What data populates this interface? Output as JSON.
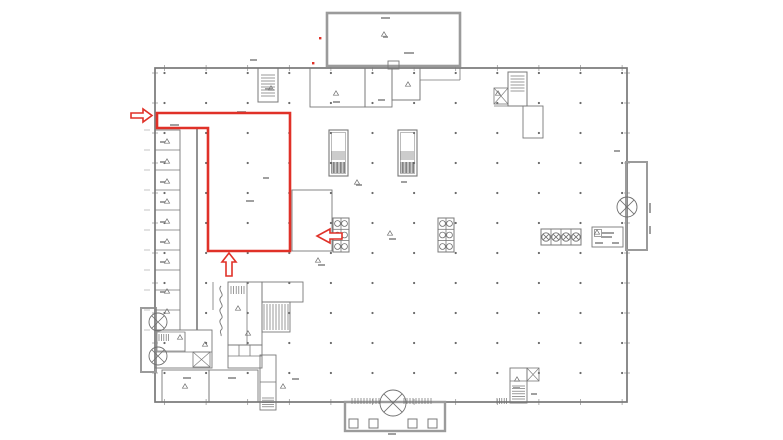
{
  "meta": {
    "description": "architectural floor plan with red highlighted zone and red arrows"
  },
  "colors": {
    "background": "#ffffff",
    "wall": "#787878",
    "wall_thick": "#9b9b9b",
    "hatch": "#6f6f6f",
    "hatch_dark": "#4f4f4f",
    "dot": "#6a6a6a",
    "tick": "#8d8d8d",
    "mark": "#a0a0a0",
    "symbol": "#6f6f6f",
    "red": "#e03128"
  },
  "plan": {
    "canvas": {
      "w": 783,
      "h": 440
    },
    "grid": {
      "x0": 164.5,
      "dx": 41.6,
      "cols": 12,
      "y0": 73,
      "dy": 30,
      "rows": 11,
      "r": 1.1
    },
    "left_dim_ticks": {
      "x1": 144,
      "x2": 150,
      "y0": 130,
      "dy": 20,
      "n": 11
    },
    "rects": [
      {
        "x": 155,
        "y": 68,
        "w": 472,
        "h": 334,
        "sw": 1.7,
        "k": "wall",
        "name": "building-outline"
      },
      {
        "x": 327,
        "y": 13,
        "w": 133,
        "h": 53,
        "sw": 2.6,
        "k": "wall_thick",
        "name": "top-annex"
      },
      {
        "x": 388,
        "y": 61,
        "w": 11,
        "h": 8,
        "sw": 0.9,
        "k": "wall",
        "name": "annex-door"
      },
      {
        "x": 345,
        "y": 402,
        "w": 100,
        "h": 29,
        "sw": 2.4,
        "k": "wall_thick",
        "name": "entrance-porch"
      },
      {
        "x": 349,
        "y": 419,
        "w": 9,
        "h": 9,
        "sw": 1,
        "k": "wall",
        "name": "porch-column"
      },
      {
        "x": 369,
        "y": 419,
        "w": 9,
        "h": 9,
        "sw": 1,
        "k": "wall",
        "name": "porch-column"
      },
      {
        "x": 408,
        "y": 419,
        "w": 9,
        "h": 9,
        "sw": 1,
        "k": "wall",
        "name": "porch-column"
      },
      {
        "x": 428,
        "y": 419,
        "w": 9,
        "h": 9,
        "sw": 1,
        "k": "wall",
        "name": "porch-column"
      },
      {
        "x": 141,
        "y": 308,
        "w": 15,
        "h": 64,
        "sw": 2,
        "k": "wall_thick",
        "name": "left-bay"
      },
      {
        "x": 626,
        "y": 162,
        "w": 21,
        "h": 88,
        "sw": 2,
        "k": "wall_thick",
        "name": "right-bay"
      },
      {
        "x": 155,
        "y": 130,
        "w": 25,
        "h": 200,
        "sw": 0.9,
        "k": "wall",
        "name": "left-room-column"
      },
      {
        "x": 155,
        "y": 330,
        "w": 57,
        "h": 38,
        "sw": 0.9,
        "k": "wall",
        "name": "left-room-block"
      },
      {
        "x": 157,
        "y": 332,
        "w": 28,
        "h": 19,
        "sw": 0.7,
        "k": "wall",
        "name": "left-inner-room"
      },
      {
        "x": 162,
        "y": 370,
        "w": 47,
        "h": 32,
        "sw": 0.9,
        "k": "wall",
        "name": "bottom-room-1"
      },
      {
        "x": 209,
        "y": 370,
        "w": 49,
        "h": 32,
        "sw": 0.9,
        "k": "wall",
        "name": "bottom-room-2"
      },
      {
        "x": 260,
        "y": 355,
        "w": 16,
        "h": 55,
        "sw": 0.9,
        "k": "wall",
        "name": "bottom-small-structure"
      },
      {
        "x": 228,
        "y": 282,
        "w": 34,
        "h": 63,
        "sw": 0.9,
        "k": "wall",
        "name": "core-room-a"
      },
      {
        "x": 262,
        "y": 282,
        "w": 41,
        "h": 20,
        "sw": 0.9,
        "k": "wall",
        "name": "core-room-b"
      },
      {
        "x": 262,
        "y": 302,
        "w": 28,
        "h": 30,
        "sw": 0.9,
        "k": "wall",
        "name": "core-stairs"
      },
      {
        "x": 228,
        "y": 345,
        "w": 34,
        "h": 23,
        "sw": 0.9,
        "k": "wall",
        "name": "core-cells"
      },
      {
        "x": 258,
        "y": 68,
        "w": 20,
        "h": 34,
        "sw": 1,
        "k": "wall",
        "name": "top-left-shaft"
      },
      {
        "x": 310,
        "y": 68,
        "w": 55,
        "h": 39,
        "sw": 0.9,
        "k": "wall",
        "name": "top-room-1"
      },
      {
        "x": 365,
        "y": 68,
        "w": 27,
        "h": 39,
        "sw": 0.9,
        "k": "wall",
        "name": "top-room-2"
      },
      {
        "x": 392,
        "y": 68,
        "w": 28,
        "h": 32,
        "sw": 0.9,
        "k": "wall",
        "name": "top-room-3"
      },
      {
        "x": 508,
        "y": 72,
        "w": 19,
        "h": 34,
        "sw": 1,
        "k": "wall",
        "name": "top-right-stair"
      },
      {
        "x": 523,
        "y": 106,
        "w": 20,
        "h": 32,
        "sw": 0.9,
        "k": "wall",
        "name": "top-right-room"
      },
      {
        "x": 292,
        "y": 190,
        "w": 40,
        "h": 61,
        "sw": 0.9,
        "k": "wall",
        "name": "mid-room"
      },
      {
        "x": 329,
        "y": 130,
        "w": 19,
        "h": 46,
        "sw": 1.1,
        "k": "wall",
        "name": "machine-1"
      },
      {
        "x": 331.5,
        "y": 132.5,
        "w": 14,
        "h": 41,
        "sw": 0.5,
        "k": "wall",
        "name": "machine-1-inner"
      },
      {
        "x": 398,
        "y": 130,
        "w": 19,
        "h": 46,
        "sw": 1.1,
        "k": "wall",
        "name": "machine-2"
      },
      {
        "x": 400.5,
        "y": 132.5,
        "w": 14,
        "h": 41,
        "sw": 0.5,
        "k": "wall",
        "name": "machine-2-inner"
      },
      {
        "x": 333,
        "y": 218,
        "w": 16,
        "h": 34,
        "sw": 1,
        "k": "wall",
        "name": "equipment-rack-1"
      },
      {
        "x": 438,
        "y": 218,
        "w": 16,
        "h": 34,
        "sw": 1,
        "k": "wall",
        "name": "equipment-rack-2"
      },
      {
        "x": 541,
        "y": 229,
        "w": 40,
        "h": 16,
        "sw": 1,
        "k": "wall",
        "name": "fan-unit-row"
      },
      {
        "x": 592,
        "y": 227,
        "w": 31,
        "h": 20,
        "sw": 0.9,
        "k": "wall",
        "name": "legend-box"
      },
      {
        "x": 594.5,
        "y": 229.5,
        "w": 7,
        "h": 7,
        "sw": 0.7,
        "k": "wall",
        "name": "legend-square"
      },
      {
        "x": 510,
        "y": 368,
        "w": 17,
        "h": 35,
        "sw": 0.9,
        "k": "wall",
        "name": "bottom-right-room"
      }
    ],
    "lines": [
      {
        "x1": 155,
        "y1": 150,
        "x2": 180,
        "y2": 150
      },
      {
        "x1": 155,
        "y1": 170,
        "x2": 180,
        "y2": 170
      },
      {
        "x1": 155,
        "y1": 190,
        "x2": 180,
        "y2": 190
      },
      {
        "x1": 155,
        "y1": 210,
        "x2": 180,
        "y2": 210
      },
      {
        "x1": 155,
        "y1": 230,
        "x2": 180,
        "y2": 230
      },
      {
        "x1": 155,
        "y1": 250,
        "x2": 180,
        "y2": 250
      },
      {
        "x1": 155,
        "y1": 270,
        "x2": 180,
        "y2": 270
      },
      {
        "x1": 155,
        "y1": 290,
        "x2": 180,
        "y2": 290
      },
      {
        "x1": 155,
        "y1": 310,
        "x2": 180,
        "y2": 310
      },
      {
        "x1": 197,
        "y1": 128,
        "x2": 197,
        "y2": 330,
        "sw": 1.6
      },
      {
        "x1": 155,
        "y1": 352,
        "x2": 212,
        "y2": 352,
        "sw": 0.7
      },
      {
        "x1": 185,
        "y1": 332,
        "x2": 185,
        "y2": 352,
        "sw": 0.7
      },
      {
        "x1": 260,
        "y1": 382,
        "x2": 276,
        "y2": 382
      },
      {
        "x1": 247,
        "y1": 282,
        "x2": 247,
        "y2": 345
      },
      {
        "x1": 213,
        "y1": 282,
        "x2": 213,
        "y2": 310
      },
      {
        "x1": 239,
        "y1": 345,
        "x2": 239,
        "y2": 356
      },
      {
        "x1": 250,
        "y1": 345,
        "x2": 250,
        "y2": 356
      },
      {
        "x1": 228,
        "y1": 356,
        "x2": 262,
        "y2": 356
      },
      {
        "x1": 420,
        "y1": 80,
        "x2": 460,
        "y2": 80
      },
      {
        "x1": 460,
        "y1": 68,
        "x2": 460,
        "y2": 80
      },
      {
        "x1": 420,
        "y1": 80,
        "x2": 420,
        "y2": 100
      },
      {
        "x1": 392,
        "y1": 100,
        "x2": 420,
        "y2": 100
      },
      {
        "x1": 494,
        "y1": 106,
        "x2": 527,
        "y2": 106
      },
      {
        "x1": 551,
        "y1": 229,
        "x2": 551,
        "y2": 245
      },
      {
        "x1": 561,
        "y1": 229,
        "x2": 561,
        "y2": 245
      },
      {
        "x1": 571,
        "y1": 229,
        "x2": 571,
        "y2": 245
      },
      {
        "x1": 333,
        "y1": 229.3,
        "x2": 349,
        "y2": 229.3
      },
      {
        "x1": 333,
        "y1": 240.6,
        "x2": 349,
        "y2": 240.6
      },
      {
        "x1": 341,
        "y1": 218,
        "x2": 341,
        "y2": 252
      },
      {
        "x1": 438,
        "y1": 229.3,
        "x2": 454,
        "y2": 229.3
      },
      {
        "x1": 438,
        "y1": 240.6,
        "x2": 454,
        "y2": 240.6
      },
      {
        "x1": 446,
        "y1": 218,
        "x2": 446,
        "y2": 252
      },
      {
        "x1": 510,
        "y1": 381,
        "x2": 527,
        "y2": 381
      }
    ],
    "combs": [
      {
        "x": 261,
        "y": 75,
        "w": 14,
        "h": 21,
        "dir": "h",
        "gap": 3
      },
      {
        "x": 510.5,
        "y": 76,
        "w": 14,
        "h": 15,
        "dir": "h",
        "gap": 3
      },
      {
        "x": 332,
        "y": 151,
        "w": 13,
        "h": 9,
        "dir": "v",
        "gap": 2
      },
      {
        "x": 332,
        "y": 162,
        "w": 13,
        "h": 11,
        "dir": "v",
        "gap": 1.4,
        "dark": true
      },
      {
        "x": 401,
        "y": 151,
        "w": 13,
        "h": 9,
        "dir": "v",
        "gap": 2
      },
      {
        "x": 401,
        "y": 162,
        "w": 13,
        "h": 11,
        "dir": "v",
        "gap": 1.4,
        "dark": true
      },
      {
        "x": 264,
        "y": 304,
        "w": 24,
        "h": 26,
        "dir": "v",
        "gap": 3
      },
      {
        "x": 262,
        "y": 398,
        "w": 12,
        "h": 9,
        "dir": "h",
        "gap": 2.2
      },
      {
        "x": 512,
        "y": 386,
        "w": 13,
        "h": 14,
        "dir": "h",
        "gap": 2.6
      },
      {
        "x": 352,
        "y": 398,
        "w": 28,
        "h": 6,
        "dir": "v",
        "gap": 3
      },
      {
        "x": 404,
        "y": 398,
        "w": 28,
        "h": 6,
        "dir": "v",
        "gap": 3
      },
      {
        "x": 497,
        "y": 398,
        "w": 11,
        "h": 6,
        "dir": "v",
        "gap": 2.4
      },
      {
        "x": 231,
        "y": 286,
        "w": 13,
        "h": 8,
        "dir": "v",
        "gap": 2.6
      },
      {
        "x": 159,
        "y": 334,
        "w": 10,
        "h": 7,
        "dir": "v",
        "gap": 2.4
      }
    ],
    "xrects": [
      {
        "x": 494,
        "y": 88,
        "w": 14,
        "h": 16
      },
      {
        "x": 527,
        "y": 368,
        "w": 12,
        "h": 13
      },
      {
        "x": 193,
        "y": 352,
        "w": 17,
        "h": 15
      }
    ],
    "circle_x": [
      {
        "cx": 393,
        "cy": 403,
        "r": 13
      },
      {
        "cx": 158,
        "cy": 322,
        "r": 9
      },
      {
        "cx": 158,
        "cy": 356,
        "r": 9
      },
      {
        "cx": 627,
        "cy": 207,
        "r": 10
      },
      {
        "cx": 546,
        "cy": 237,
        "r": 4.2
      },
      {
        "cx": 556,
        "cy": 237,
        "r": 4.2
      },
      {
        "cx": 566,
        "cy": 237,
        "r": 4.2
      },
      {
        "cx": 576,
        "cy": 237,
        "r": 4.2
      }
    ],
    "rack_circles": [
      {
        "cx": 337.5,
        "cy": 223.5
      },
      {
        "cx": 344.5,
        "cy": 223.5
      },
      {
        "cx": 337.5,
        "cy": 235
      },
      {
        "cx": 344.5,
        "cy": 235
      },
      {
        "cx": 337.5,
        "cy": 246.5
      },
      {
        "cx": 344.5,
        "cy": 246.5
      },
      {
        "cx": 442.5,
        "cy": 223.5
      },
      {
        "cx": 449.5,
        "cy": 223.5
      },
      {
        "cx": 442.5,
        "cy": 235
      },
      {
        "cx": 449.5,
        "cy": 235
      },
      {
        "cx": 442.5,
        "cy": 246.5
      },
      {
        "cx": 449.5,
        "cy": 246.5
      }
    ],
    "rack_circle_r": 2.9,
    "marks": [
      [
        237,
        111,
        9
      ],
      [
        170,
        124,
        9
      ],
      [
        381,
        17,
        9
      ],
      [
        404,
        52,
        10
      ],
      [
        333,
        101,
        7
      ],
      [
        378,
        99,
        7
      ],
      [
        265,
        88,
        7
      ],
      [
        250,
        59,
        7
      ],
      [
        246,
        200,
        8
      ],
      [
        263,
        177,
        6
      ],
      [
        356,
        184,
        6
      ],
      [
        401,
        181,
        6
      ],
      [
        389,
        238,
        7
      ],
      [
        318,
        264,
        7
      ],
      [
        183,
        377,
        8
      ],
      [
        228,
        377,
        8
      ],
      [
        292,
        378,
        7
      ],
      [
        388,
        433,
        8
      ],
      [
        513,
        387,
        7
      ],
      [
        531,
        393,
        6
      ],
      [
        614,
        150,
        6
      ],
      [
        601,
        232,
        13
      ],
      [
        601,
        236,
        11
      ],
      [
        595,
        242,
        8
      ],
      [
        612,
        242,
        7
      ],
      [
        383,
        36,
        5
      ],
      [
        160,
        141,
        5
      ],
      [
        160,
        161,
        5
      ],
      [
        160,
        181,
        5
      ],
      [
        160,
        201,
        5
      ],
      [
        160,
        221,
        5
      ],
      [
        160,
        241,
        5
      ],
      [
        160,
        261,
        5
      ],
      [
        160,
        291,
        5
      ]
    ],
    "vmarks": [
      [
        649,
        203,
        10
      ],
      [
        649,
        226,
        8
      ]
    ],
    "triangles": [
      [
        167,
        141
      ],
      [
        167,
        161
      ],
      [
        167,
        181
      ],
      [
        167,
        201
      ],
      [
        167,
        221
      ],
      [
        167,
        241
      ],
      [
        167,
        261
      ],
      [
        167,
        291
      ],
      [
        167,
        311
      ],
      [
        180,
        337
      ],
      [
        205,
        344
      ],
      [
        185,
        386
      ],
      [
        283,
        386
      ],
      [
        384,
        34
      ],
      [
        336,
        93
      ],
      [
        408,
        84
      ],
      [
        498,
        93
      ],
      [
        238,
        308
      ],
      [
        248,
        333
      ],
      [
        357,
        182
      ],
      [
        390,
        233
      ],
      [
        318,
        260
      ],
      [
        517,
        379
      ],
      [
        597,
        232
      ],
      [
        271,
        88
      ]
    ],
    "squiggle": "M221,286 c-4,4 4,8 0,11 c-4,4 4,8 0,11 c-4,4 4,8 0,11 c-4,4 4,8 0,11 c-2,2 1,4 0,6",
    "red": {
      "outline": "157,113 290,113 290,251 208,251 208,128 157,128",
      "outline_width": 2.6,
      "arrows": [
        {
          "name": "red-arrow-right",
          "points": "131,113 143,113 143,109 152,115.5 143,122 143,118 131,118"
        },
        {
          "name": "red-arrow-left",
          "points": "342,233 330,233 330,229 317,236 330,243 330,239 342,239"
        },
        {
          "name": "red-arrow-up",
          "points": "226,276 226,262 222,262 229,253 236,262 232,262 232,276"
        }
      ],
      "dots": [
        [
          319,
          37
        ],
        [
          312,
          62
        ]
      ]
    }
  }
}
